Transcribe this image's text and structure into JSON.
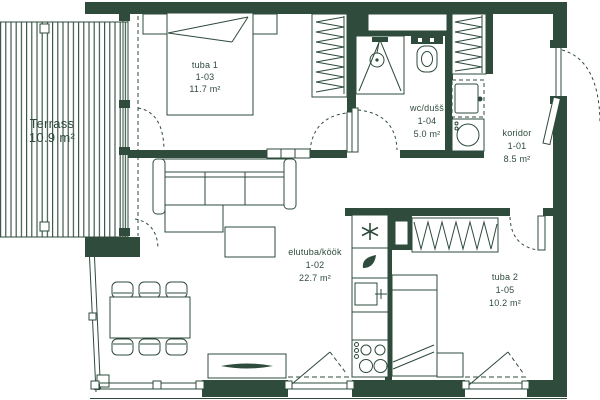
{
  "plan": {
    "colors": {
      "wall": "#2e4b3c",
      "background": "#ffffff"
    },
    "rooms": [
      {
        "id": "terrass",
        "name": "Terrass",
        "code": "",
        "area": "10.9 m²"
      },
      {
        "id": "tuba1",
        "name": "tuba 1",
        "code": "1-03",
        "area": "11.7 m²"
      },
      {
        "id": "wc",
        "name": "wc/dušš",
        "code": "1-04",
        "area": "5.0 m²"
      },
      {
        "id": "koridor",
        "name": "koridor",
        "code": "1-01",
        "area": "8.5 m²"
      },
      {
        "id": "elutuba",
        "name": "elutuba/köök",
        "code": "1-02",
        "area": "22.7 m²"
      },
      {
        "id": "tuba2",
        "name": "tuba 2",
        "code": "1-05",
        "area": "10.2 m²"
      }
    ],
    "icons": {
      "freezer-star-icon": "✱",
      "water-heater-icon": "drop",
      "shower-icon": "circle with spray lines",
      "toilet-icon": "bowl with cistern",
      "washing-machine-icon": "circle in square",
      "cooktop-icon": "four burner circles",
      "kitchen-sink-icon": "basin with faucet cross",
      "wardrobe-icon": "hanger zigzag rail",
      "door-swing-icon": "quarter arc",
      "window-tilt-icon": "opening triangle"
    }
  }
}
